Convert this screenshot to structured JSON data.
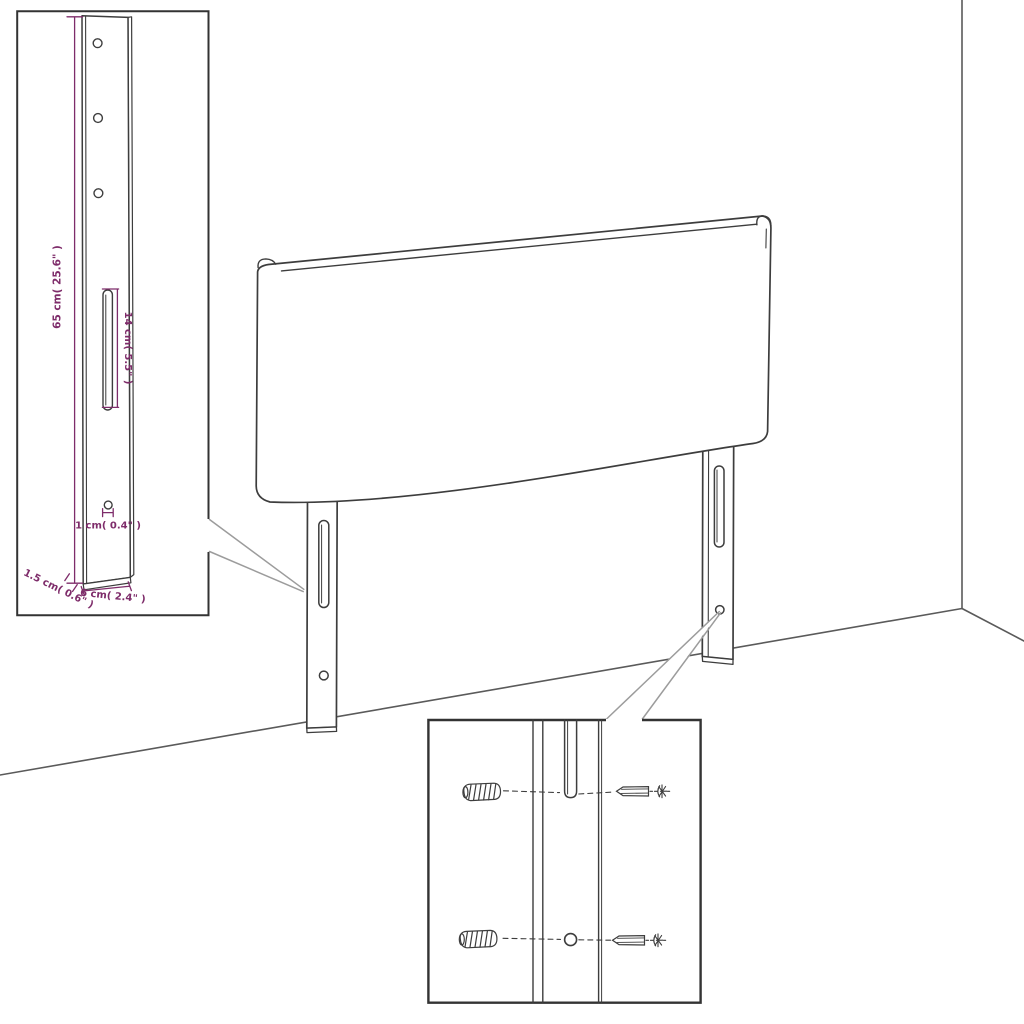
{
  "colors": {
    "outline": "#3d3d3d",
    "scene_line": "#5a5a5a",
    "callout_line": "#9c9c9c",
    "box_border": "#333333",
    "dimension": "#7e2c6a",
    "background": "#ffffff"
  },
  "bracket_inset": {
    "dim_height_label": "65 cm( 25.6\" )",
    "dim_slot_label": "14 cm( 5.5\" )",
    "dim_hole_label": "1 cm( 0.4\" )",
    "dim_thickness_label": "1.5 cm( 0.6\" )",
    "dim_width_label": "6 cm( 2.4\" )"
  }
}
